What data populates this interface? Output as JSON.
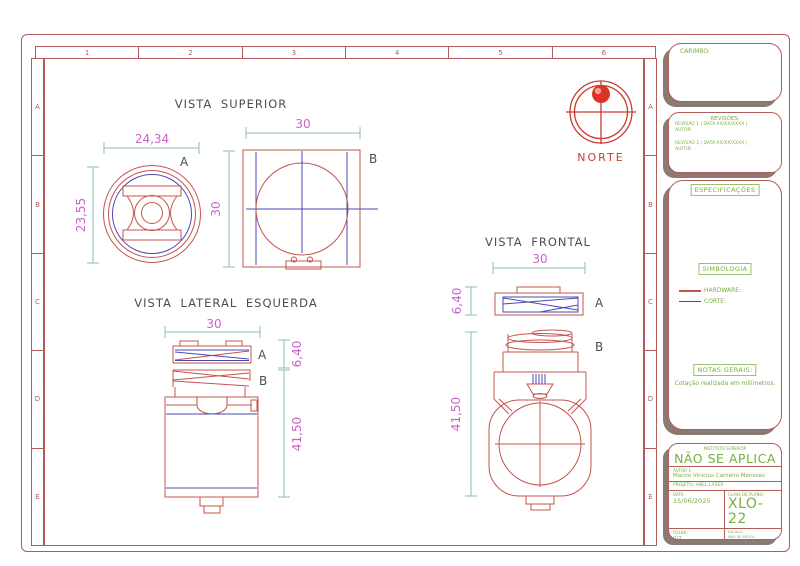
{
  "sheet": {
    "frame": {
      "columns": [
        "1",
        "2",
        "3",
        "4",
        "5",
        "6"
      ],
      "rows": [
        "A",
        "B",
        "C",
        "D",
        "E"
      ]
    },
    "views": {
      "superior": {
        "title": "VISTA SUPERIOR",
        "label_a": "A",
        "label_b": "B",
        "dims": {
          "width_a": "24,34",
          "height_a": "23,55",
          "width_b": "30",
          "height_b": "30"
        }
      },
      "lateral": {
        "title": "VISTA  LATERAL  ESQUERDA",
        "label_a": "A",
        "label_b": "B",
        "dims": {
          "width": "30",
          "height_a": "6,40",
          "height_body": "41,50"
        }
      },
      "frontal": {
        "title": "VISTA  FRONTAL",
        "label_a": "A",
        "label_b": "B",
        "dims": {
          "width": "30",
          "height_a": "6,40",
          "height_body": "41,50"
        }
      }
    },
    "north": {
      "label": "NORTE"
    },
    "titleblock": {
      "carimbo_label": "CARIMBO:",
      "revisions": {
        "title": "REVISÕES:",
        "lines": [
          "REVISÃO 1 | DATA:XX/XX/XXXX |",
          "AUTOR:",
          "REVISÃO 2 | DATA:XX/XX/XXXX |",
          "AUTOR:"
        ]
      },
      "especificacoes_label": "ESPECIFICAÇÕES",
      "simbologia": {
        "title": "SIMBOLOGIA",
        "hardware_label": "HARDWARE:",
        "corte_label": "CORTE:"
      },
      "notas": {
        "title": "NOTAS GERAIS:",
        "text": "Cotação realizada em milímetros."
      },
      "stamp": {
        "institute": "INSTITUTO SUPERIOR",
        "not_applicable": "NÃO SE APLICA",
        "author_label": "AUTOR 1:",
        "author": "Marcio Vinicius Carneiro Menezes",
        "project": "PROJETO: ANEL LASER",
        "date_label": "DATA:",
        "date": "15/06/2025",
        "plan_key_label": "CLAVE DE PLANO:",
        "plan_key": "XLO-22",
        "sheet_label": "FOLHA:",
        "sheet_number": "2/2",
        "scale_label": "ESCALA:",
        "scale": "NÃO SE APLICA",
        "unit_label": "COTAÇÃO EM:",
        "unit": "CENTÍMETROS"
      }
    },
    "colors": {
      "hardware_red": "#c4534b",
      "corte_blue": "#4949b0",
      "dimension_text": "#c963c9",
      "dimension_line": "#8cbcab",
      "annotation_green": "#76ae3f",
      "frame_red": "#b25b58",
      "north_red": "#cc3a2e"
    }
  }
}
